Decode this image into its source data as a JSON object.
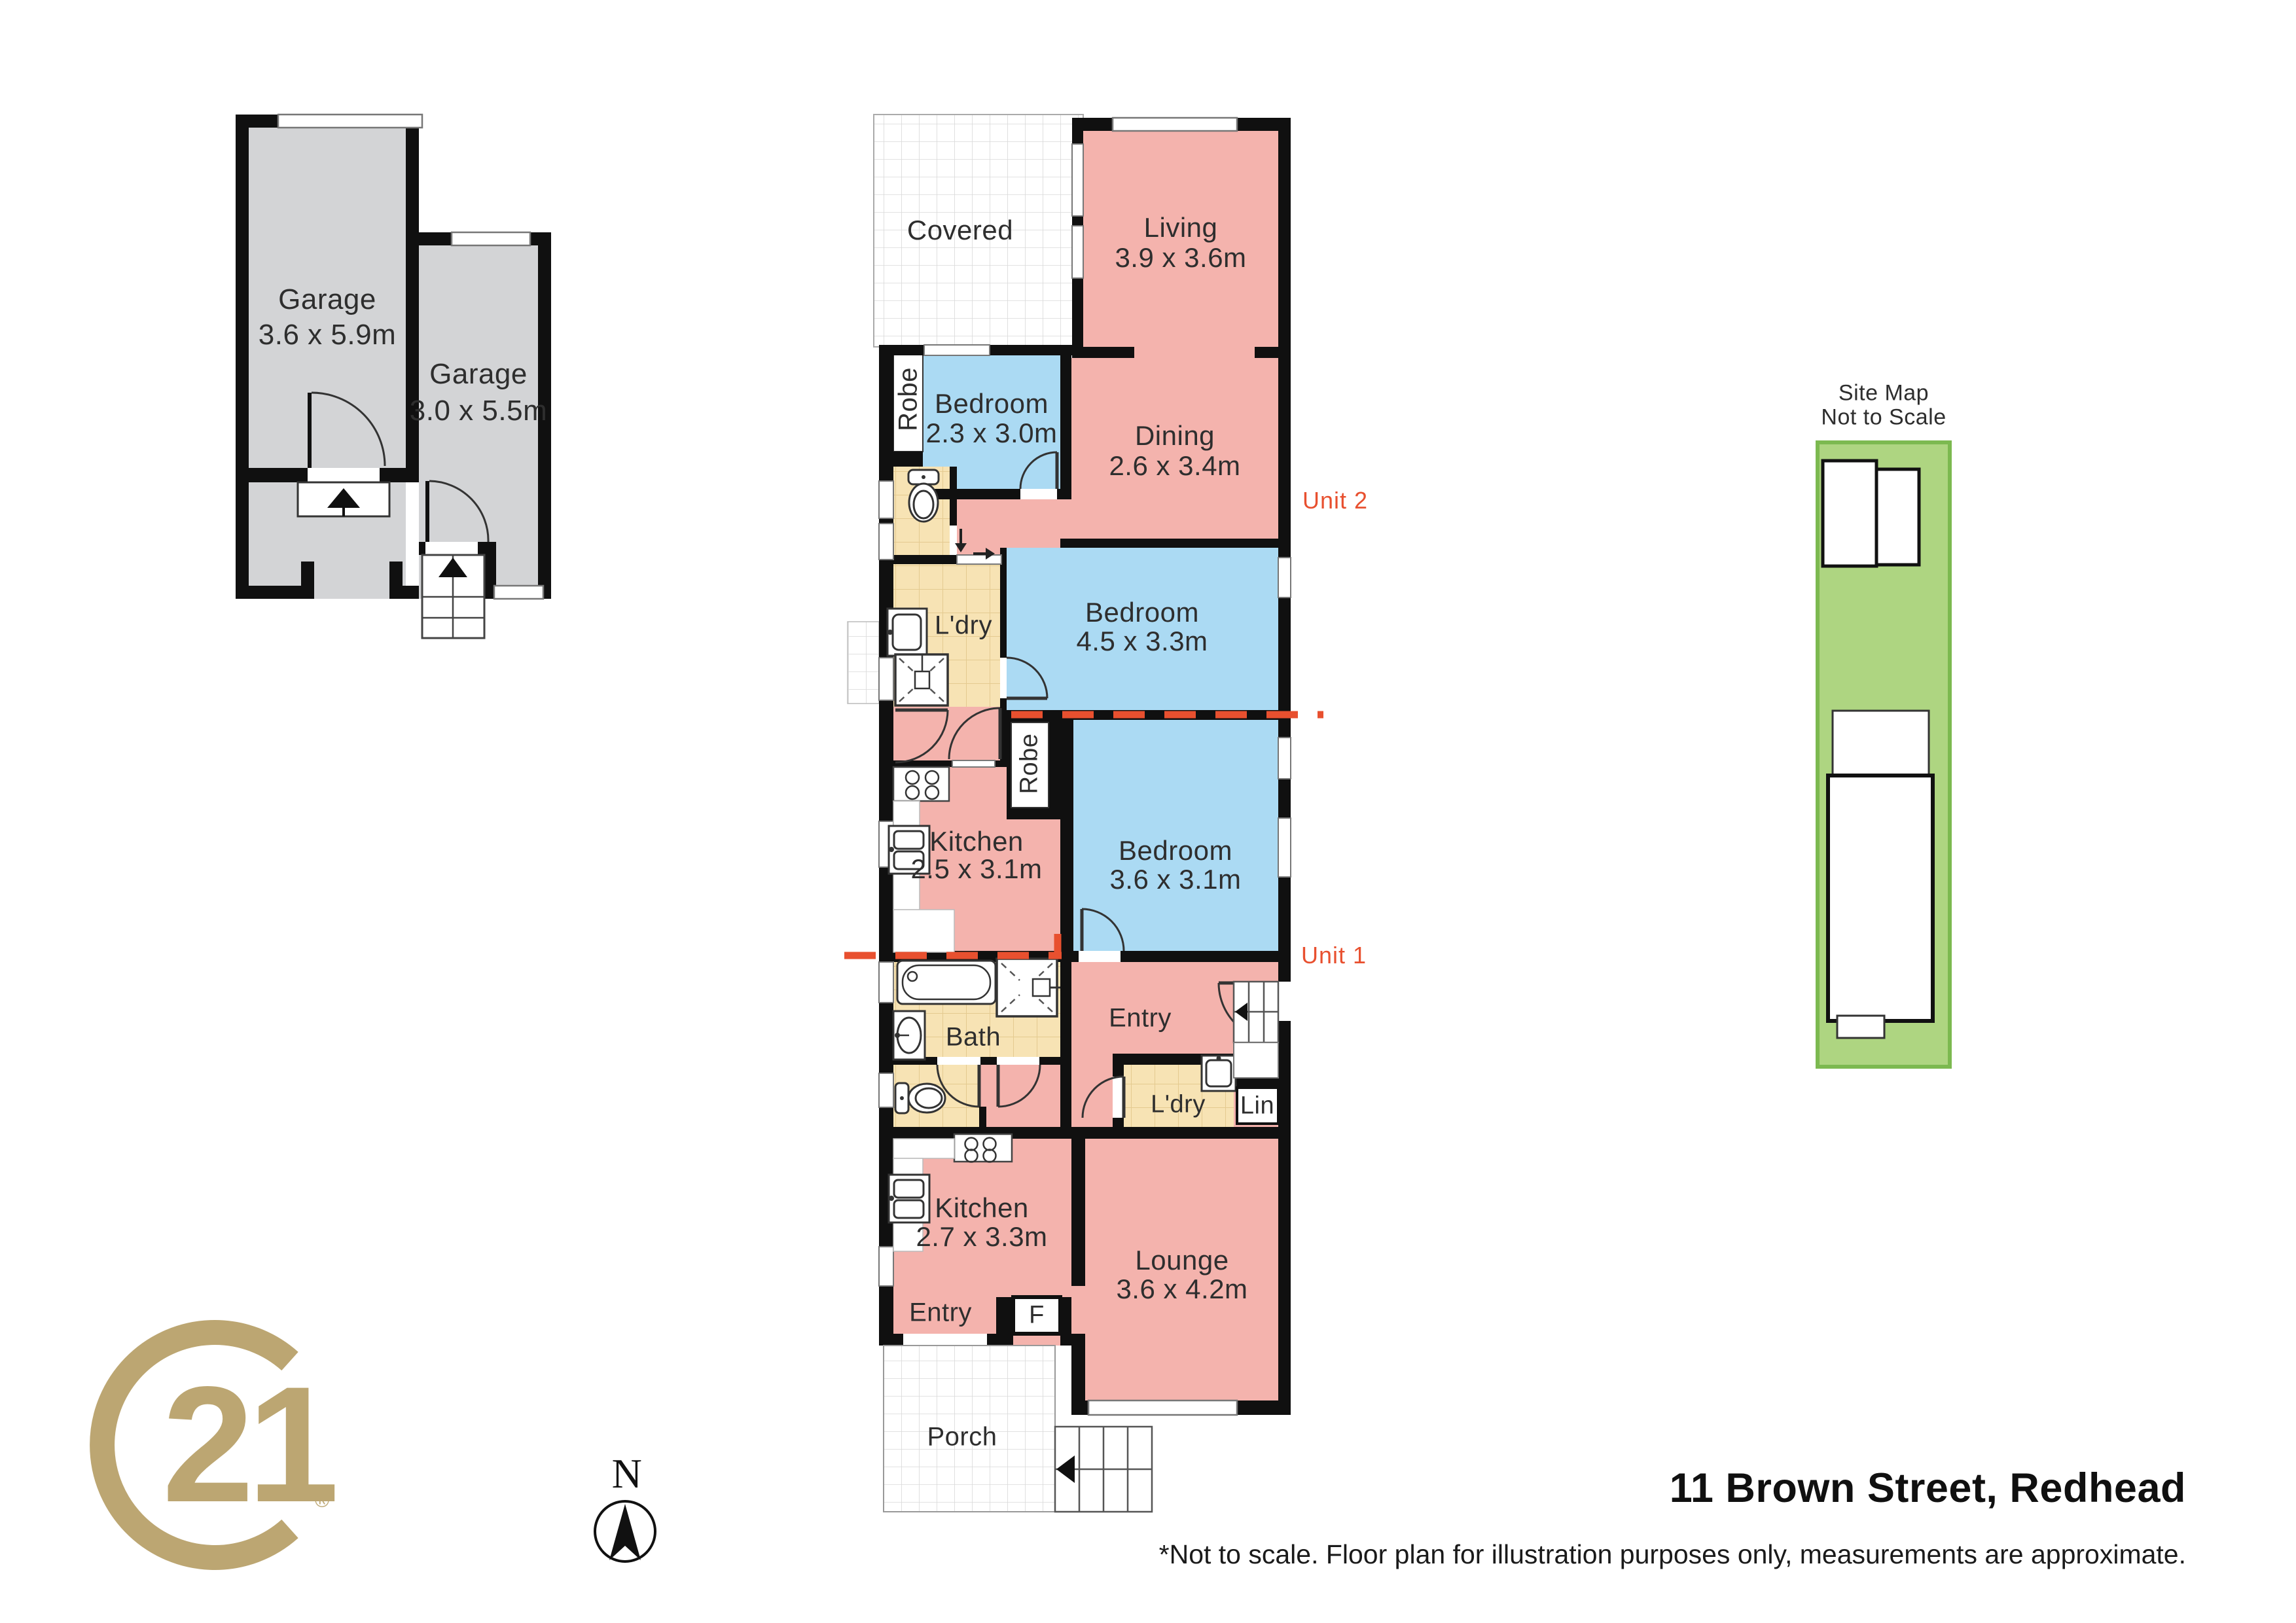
{
  "meta": {
    "address": "11 Brown Street, Redhead",
    "disclaimer": "*Not to scale. Floor plan for illustration purposes only, measurements are approximate."
  },
  "units": {
    "unit1": "Unit 1",
    "unit2": "Unit 2"
  },
  "site_map": {
    "title_line1": "Site Map",
    "title_line2": "Not to Scale"
  },
  "compass": {
    "north": "N"
  },
  "logo": {
    "number": "21",
    "registered": "®"
  },
  "rooms": {
    "garage1": {
      "name": "Garage",
      "dims": "3.6 x 5.9m"
    },
    "garage2": {
      "name": "Garage",
      "dims": "3.0 x 5.5m"
    },
    "covered": {
      "name": "Covered"
    },
    "living": {
      "name": "Living",
      "dims": "3.9 x 3.6m"
    },
    "bedroom1": {
      "name": "Bedroom",
      "dims": "2.3 x 3.0m"
    },
    "dining": {
      "name": "Dining",
      "dims": "2.6 x 3.4m"
    },
    "robe1": {
      "name": "Robe"
    },
    "ldry2": {
      "name": "L'dry"
    },
    "bedroom2": {
      "name": "Bedroom",
      "dims": "4.5 x 3.3m"
    },
    "kitchen2": {
      "name": "Kitchen",
      "dims": "2.5 x 3.1m"
    },
    "robe2": {
      "name": "Robe"
    },
    "bedroom3": {
      "name": "Bedroom",
      "dims": "3.6 x 3.1m"
    },
    "bath": {
      "name": "Bath"
    },
    "entry1": {
      "name": "Entry"
    },
    "ldry1": {
      "name": "L'dry"
    },
    "lin": {
      "name": "Lin"
    },
    "kitchen1": {
      "name": "Kitchen",
      "dims": "2.7 x 3.3m"
    },
    "lounge": {
      "name": "Lounge",
      "dims": "3.6 x 4.2m"
    },
    "entry2": {
      "name": "Entry"
    },
    "fridge": {
      "name": "F"
    },
    "porch": {
      "name": "Porch"
    }
  },
  "colors": {
    "room_pink": "#F4B3AD",
    "room_blue": "#ABDAF3",
    "room_tan": "#F7E3B4",
    "garage_grey": "#D3D4D6",
    "wall_black": "#101010",
    "site_green_fill": "#AED581",
    "site_green_border": "#7CB950",
    "unit_label_orange": "#E8502F",
    "logo_gold": "#BCA672"
  }
}
